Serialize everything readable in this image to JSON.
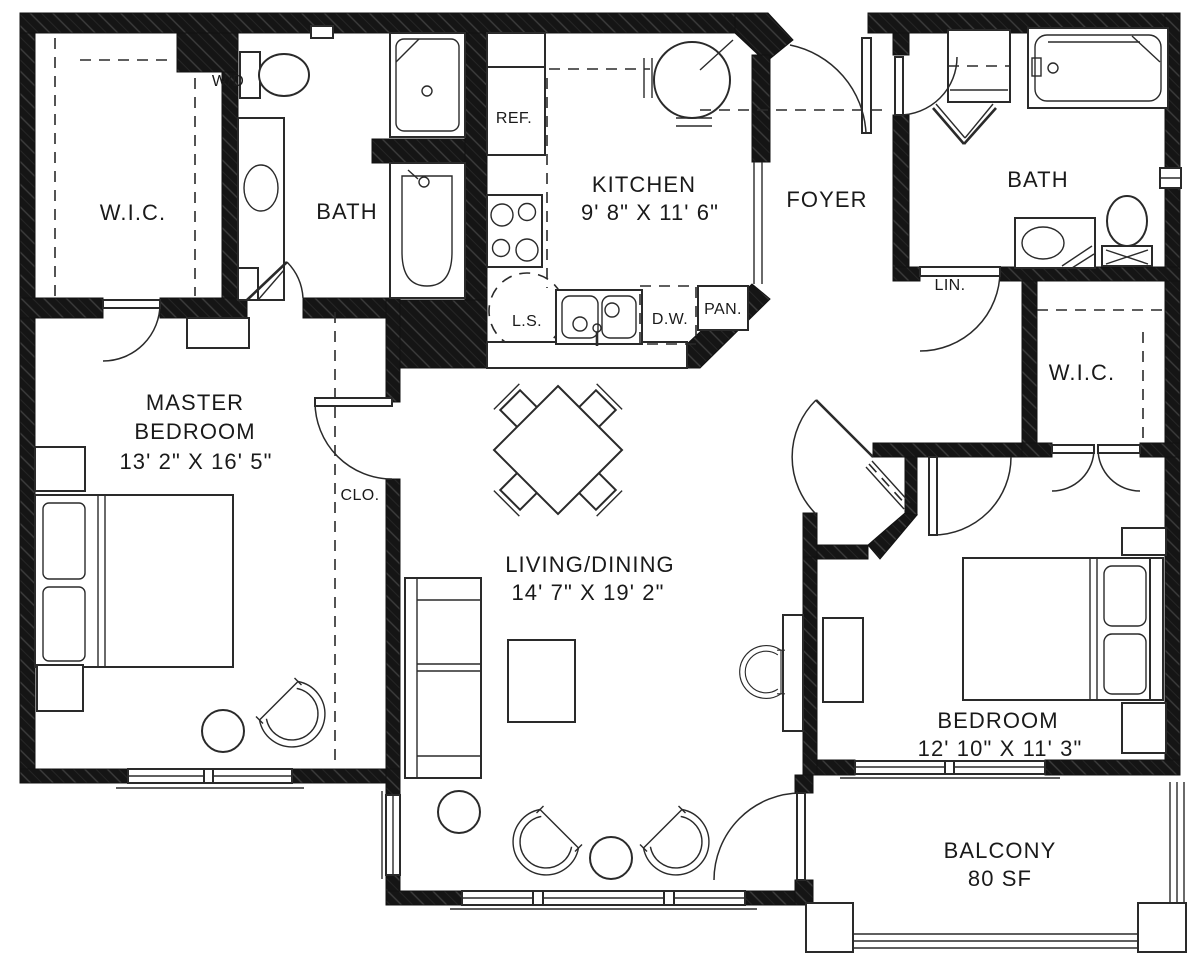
{
  "colors": {
    "wall": "#151515",
    "line": "#2a2a2a",
    "background": "#ffffff"
  },
  "rooms": {
    "wic_left": {
      "label": "W.I.C."
    },
    "master_bath": {
      "label": "BATH"
    },
    "kitchen": {
      "label": "KITCHEN",
      "dimensions": "9' 8\" X 11' 6\""
    },
    "foyer": {
      "label": "FOYER"
    },
    "bath_2": {
      "label": "BATH"
    },
    "wic_right": {
      "label": "W.I.C."
    },
    "master_bedroom": {
      "line1": "MASTER",
      "line2": "BEDROOM",
      "dimensions": "13' 2\" X 16' 5\""
    },
    "living_dining": {
      "label": "LIVING/DINING",
      "dimensions": "14' 7\" X 19' 2\""
    },
    "bedroom": {
      "label": "BEDROOM",
      "dimensions": "12' 10\" X 11' 3\""
    },
    "balcony": {
      "label": "BALCONY",
      "area": "80 SF"
    }
  },
  "fixtures": {
    "washer_dryer": "W/D",
    "refrigerator": "REF.",
    "lazy_susan": "L.S.",
    "dishwasher": "D.W.",
    "pantry": "PAN.",
    "linen_closet": "LIN.",
    "closet": "CLO."
  }
}
